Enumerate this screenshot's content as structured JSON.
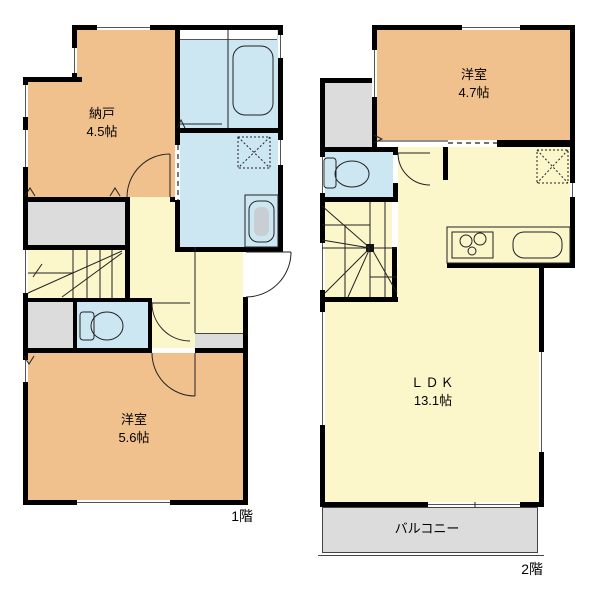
{
  "floors": [
    {
      "floor_label": "1階",
      "rooms": [
        {
          "name": "納戸",
          "size": "4.5帖"
        },
        {
          "name": "洋室",
          "size": "5.6帖"
        }
      ]
    },
    {
      "floor_label": "2階",
      "rooms": [
        {
          "name": "洋室",
          "size": "4.7帖"
        },
        {
          "name": "ＬＤＫ",
          "size": "13.1帖"
        }
      ],
      "balcony_label": "バルコニー"
    }
  ],
  "colors": {
    "room": "#f0c18c",
    "floor": "#fbf7cb",
    "wet": "#cce7f2",
    "gray": "#dcdcdc",
    "wall": "#000000"
  },
  "fixtures": [
    "bathtub",
    "toilet",
    "washbasin",
    "washing-machine-pan",
    "gas-stove",
    "kitchen-sink",
    "straight-stairs",
    "winder-stairs",
    "door-swing",
    "sliding-door",
    "window",
    "balcony"
  ]
}
